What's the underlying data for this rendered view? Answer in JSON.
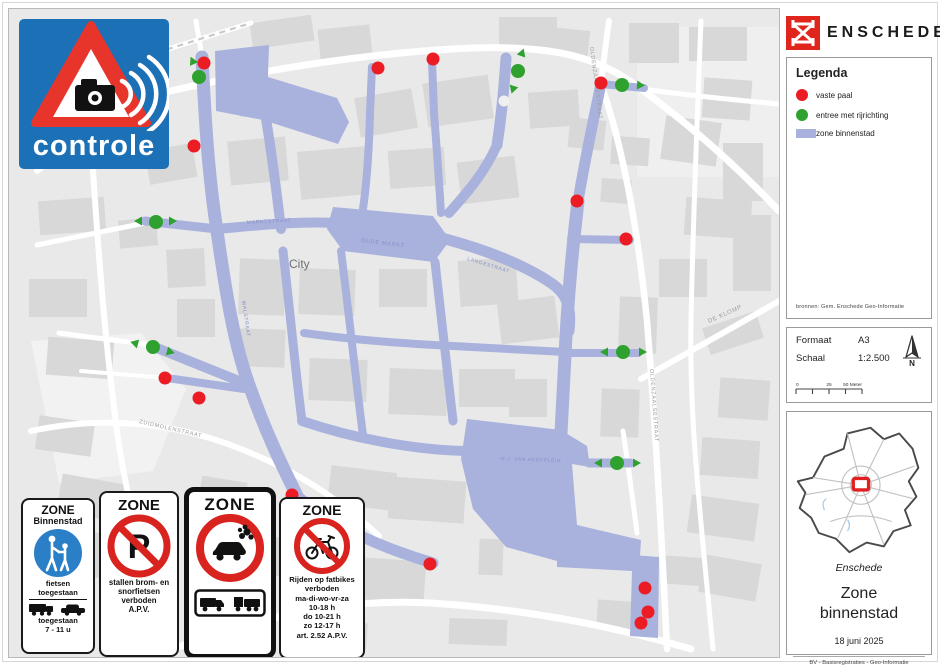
{
  "colors": {
    "zone": "#a9b2dd",
    "marker_red": "#ec1c24",
    "marker_green": "#2fa12e",
    "sign_blue": "#1c70b6",
    "logo_red": "#e0251c",
    "prohibition_red": "#d8231f"
  },
  "controle": {
    "label": "controle"
  },
  "logo": {
    "text": "ENSCHEDE"
  },
  "legend": {
    "title": "Legenda",
    "items": [
      {
        "type": "dot",
        "color": "#ec1c24",
        "label": "vaste paal"
      },
      {
        "type": "dot",
        "color": "#2fa12e",
        "label": "entree met rijrichting"
      },
      {
        "type": "swatch",
        "color": "#a9b2dd",
        "label": "zone binnenstad"
      }
    ],
    "source": "bronnen: Gem. Enschede Geo-Informatie"
  },
  "info": {
    "format_label": "Formaat",
    "format_value": "A3",
    "scale_label": "Schaal",
    "scale_value": "1:2.500",
    "north_label": "N",
    "scalebar": [
      "0",
      "25",
      "50 Meter"
    ]
  },
  "title_block": {
    "place": "Enschede",
    "line1": "Zone",
    "line2": "binnenstad",
    "date": "18 juni 2025",
    "credit": "BV - Basisregistraties - Geo-Informatie"
  },
  "signs": {
    "s1": {
      "header": "ZONE",
      "subheader": "Binnenstad",
      "bikes1": "fietsen",
      "bikes2": "toegestaan",
      "veh1": "toegestaan",
      "veh2": "7 - 11 u"
    },
    "s2": {
      "header": "ZONE",
      "lines": [
        "stallen brom- en",
        "snorfietsen",
        "verboden",
        "A.P.V."
      ]
    },
    "s3": {
      "header": "ZONE"
    },
    "s4": {
      "header": "ZONE",
      "lines": [
        "Rijden op fatbikes",
        "verboden",
        "ma-di-wo-vr-za",
        "10-18 h",
        "do 10-21 h",
        "zo 12-17 h",
        "art. 2.52 A.P.V."
      ]
    }
  },
  "map": {
    "city_label": "City",
    "street_labels": [
      {
        "text": "OLDENZAALSESTRAAT",
        "x": 589,
        "y": 46,
        "rot": 83,
        "size": 5.5,
        "color": "#9b9b9b"
      },
      {
        "text": "OLDENZAALSESTRAAT",
        "x": 649,
        "y": 368,
        "rot": 86,
        "size": 5.5,
        "color": "#9b9b9b"
      },
      {
        "text": "DE KLOMP",
        "x": 708,
        "y": 322,
        "rot": -24,
        "size": 6,
        "color": "#9b9b9b"
      },
      {
        "text": "ZUIDMOLENSTRAAT",
        "x": 138,
        "y": 422,
        "rot": 13,
        "size": 5.5,
        "color": "#9b9b9b"
      },
      {
        "text": "OUDE MARKT",
        "x": 360,
        "y": 241,
        "rot": 7,
        "size": 5.5,
        "color": "#8690c5"
      },
      {
        "text": "MARKTSTRAAT",
        "x": 246,
        "y": 223,
        "rot": -3,
        "size": 5,
        "color": "#8690c5"
      },
      {
        "text": "LANGESTRAAT",
        "x": 466,
        "y": 259,
        "rot": 17,
        "size": 5,
        "color": "#8690c5"
      },
      {
        "text": "H.J. VAN HEEKPLEIN",
        "x": 500,
        "y": 459,
        "rot": 2,
        "size": 4.8,
        "color": "#8690c5"
      },
      {
        "text": "WALSTRAAT",
        "x": 241,
        "y": 300,
        "rot": 82,
        "size": 5,
        "color": "#8690c5"
      },
      {
        "text": "City",
        "x": 288,
        "y": 267,
        "rot": 0,
        "size": 12,
        "color": "#6f6f6f"
      }
    ],
    "red_markers": [
      [
        203,
        62
      ],
      [
        193,
        145
      ],
      [
        377,
        67
      ],
      [
        432,
        58
      ],
      [
        600,
        82
      ],
      [
        576,
        200
      ],
      [
        625,
        238
      ],
      [
        164,
        377
      ],
      [
        198,
        397
      ],
      [
        291,
        494
      ],
      [
        429,
        563
      ],
      [
        644,
        587
      ],
      [
        647,
        611
      ],
      [
        640,
        622
      ]
    ],
    "green_markers": [
      {
        "x": 198,
        "y": 76,
        "arrows": [
          {
            "x": 193,
            "y": 63,
            "rot": -115
          }
        ]
      },
      {
        "x": 155,
        "y": 221,
        "arrows": [
          {
            "x": 141,
            "y": 220,
            "rot": 180
          },
          {
            "x": 168,
            "y": 220,
            "rot": 0
          }
        ]
      },
      {
        "x": 152,
        "y": 346,
        "arrows": [
          {
            "x": 137,
            "y": 343,
            "rot": -165
          },
          {
            "x": 166,
            "y": 350,
            "rot": 15
          }
        ]
      },
      {
        "x": 517,
        "y": 70,
        "arrows": [
          {
            "x": 520,
            "y": 55,
            "rot": -70
          },
          {
            "x": 513,
            "y": 85,
            "rot": 108
          }
        ]
      },
      {
        "x": 621,
        "y": 84,
        "arrows": [
          {
            "x": 636,
            "y": 84,
            "rot": 4
          }
        ]
      },
      {
        "x": 622,
        "y": 351,
        "arrows": [
          {
            "x": 607,
            "y": 351,
            "rot": 180
          },
          {
            "x": 638,
            "y": 351,
            "rot": 0
          }
        ]
      },
      {
        "x": 616,
        "y": 462,
        "arrows": [
          {
            "x": 601,
            "y": 462,
            "rot": 180
          },
          {
            "x": 632,
            "y": 462,
            "rot": 0
          }
        ]
      }
    ]
  }
}
